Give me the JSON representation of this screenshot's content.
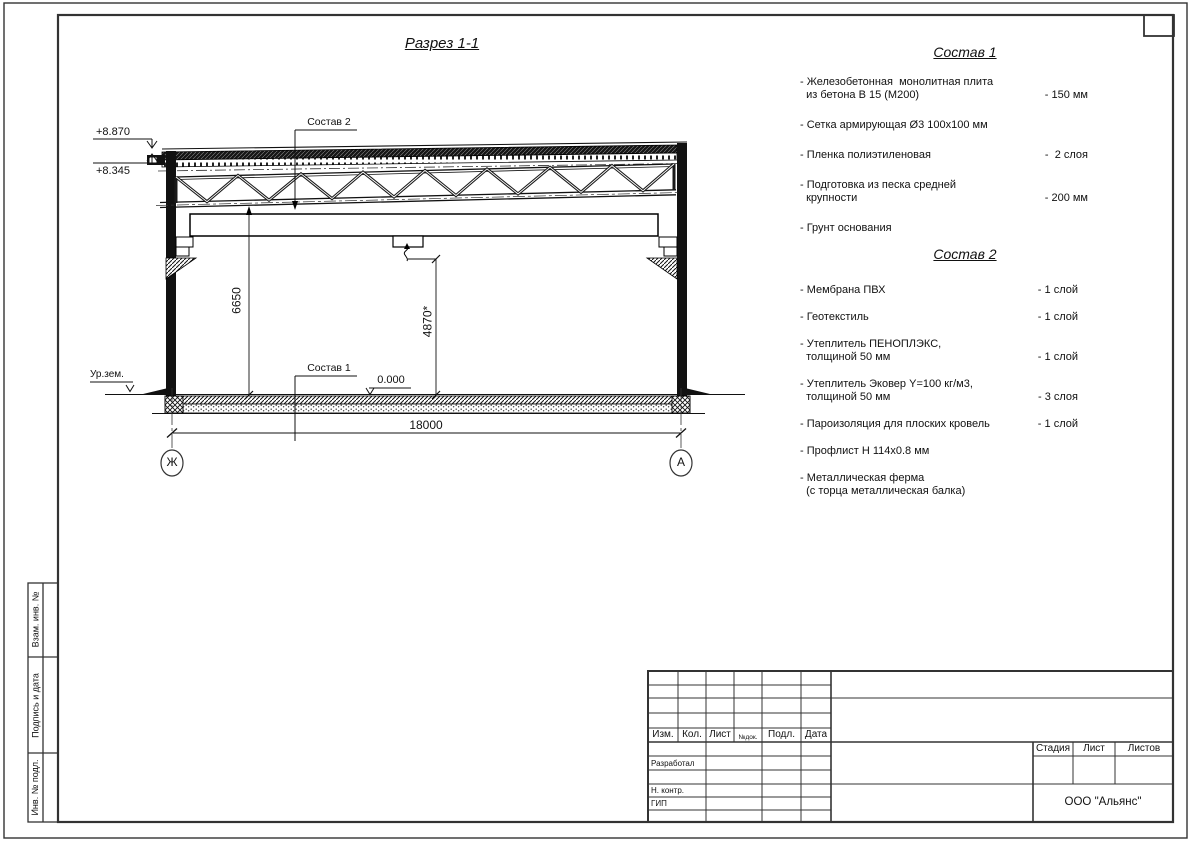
{
  "page": {
    "title": "Разрез 1-1"
  },
  "drawing": {
    "elevations": {
      "roof_top": "+8.870",
      "truss_bearing": "+8.345",
      "floor": "0.000",
      "ground_label": "Ур.зем."
    },
    "dimensions": {
      "clear_height": "6650",
      "crane_height": "4870*",
      "span": "18000"
    },
    "axes": {
      "left": "Ж",
      "right": "А"
    },
    "callouts": {
      "roof": "Состав 2",
      "floor": "Состав 1"
    }
  },
  "spec1": {
    "title": "Состав 1",
    "items": [
      {
        "text": "- Железобетонная  монолитная плита\n  из бетона В 15 (М200)",
        "value": "- 150 мм"
      },
      {
        "text": "- Сетка армирующая Ø3 100х100 мм",
        "value": ""
      },
      {
        "text": "- Пленка полиэтиленовая",
        "value": "-  2 слоя"
      },
      {
        "text": "- Подготовка из песка средней\n  крупности",
        "value": "- 200 мм"
      },
      {
        "text": "- Грунт основания",
        "value": ""
      }
    ]
  },
  "spec2": {
    "title": "Состав 2",
    "items": [
      {
        "text": "- Мембрана ПВХ",
        "value": "- 1 слой"
      },
      {
        "text": "- Геотекстиль",
        "value": "- 1 слой"
      },
      {
        "text": "- Утеплитель ПЕНОПЛЭКС,\n  толщиной 50 мм",
        "value": "- 1 слой"
      },
      {
        "text": "- Утеплитель Эковер Y=100 кг/м3,\n  толщиной 50 мм",
        "value": "- 3 слоя"
      },
      {
        "text": "- Пароизоляция для плоских кровель",
        "value": "- 1 слой"
      },
      {
        "text": "- Профлист Н 114х0.8 мм",
        "value": ""
      },
      {
        "text": "- Металлическая ферма\n  (с торца металлическая балка)",
        "value": ""
      }
    ]
  },
  "stamp": {
    "header_cols": [
      "Изм.",
      "Кол.",
      "Лист",
      "№док.",
      "Подл.",
      "Дата"
    ],
    "roles": [
      "Разработал",
      "Н. контр.",
      "ГИП"
    ],
    "stage_cols": [
      "Стадия",
      "Лист",
      "Листов"
    ],
    "company": "ООО \"Альянс\""
  },
  "side_strip": [
    "Взам. инв. №",
    "Подпись и дата",
    "Инв. № подл."
  ]
}
